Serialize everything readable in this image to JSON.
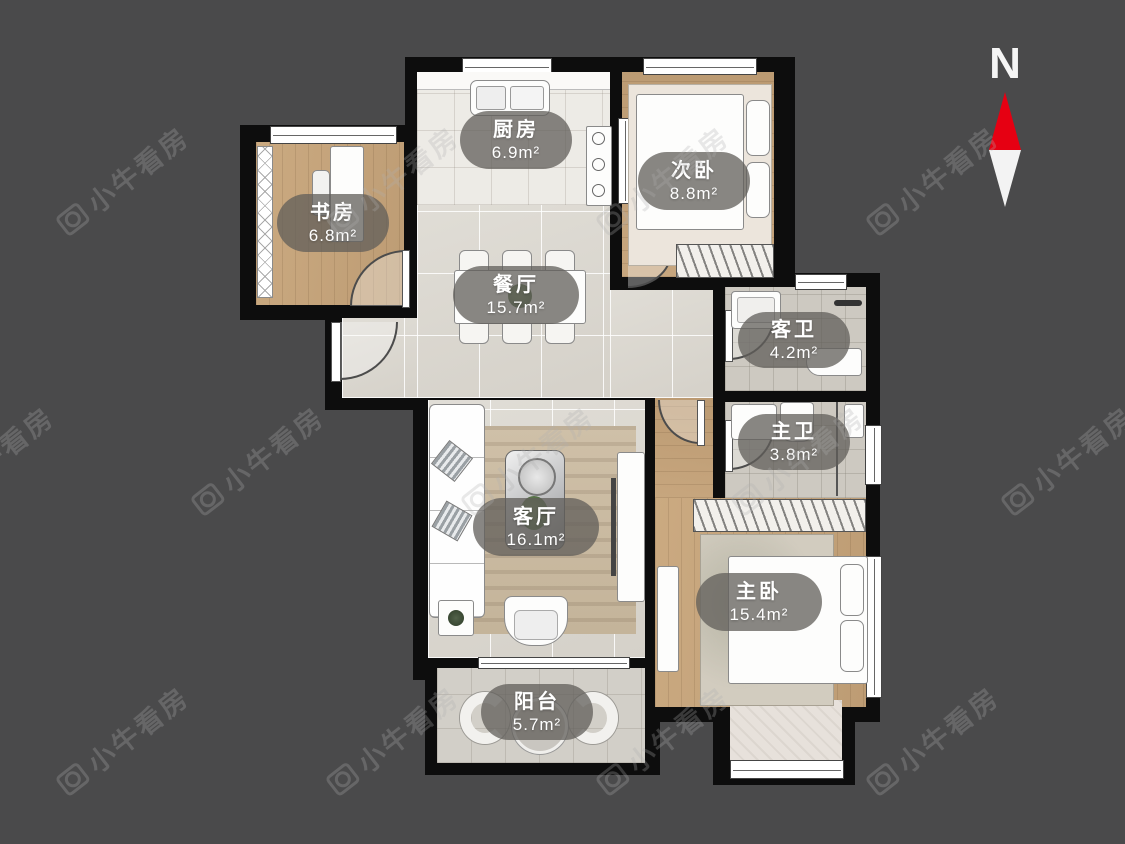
{
  "watermark": {
    "text": "小牛看房"
  },
  "compass": {
    "label": "N"
  },
  "colors": {
    "background": "#4a4a4b",
    "wall": "#0d0d0d",
    "compass_red": "#e60012",
    "compass_white": "#f5f5f5",
    "label_background": "rgba(96,93,89,0.75)",
    "label_text": "#ffffff",
    "watermark": "rgba(175,175,175,0.28)"
  },
  "rooms": [
    {
      "id": "kitchen",
      "name": "厨房",
      "area": "6.9m²"
    },
    {
      "id": "second-bedroom",
      "name": "次卧",
      "area": "8.8m²"
    },
    {
      "id": "study",
      "name": "书房",
      "area": "6.8m²"
    },
    {
      "id": "dining-room",
      "name": "餐厅",
      "area": "15.7m²"
    },
    {
      "id": "guest-bathroom",
      "name": "客卫",
      "area": "4.2m²"
    },
    {
      "id": "master-bathroom",
      "name": "主卫",
      "area": "3.8m²"
    },
    {
      "id": "living-room",
      "name": "客厅",
      "area": "16.1m²"
    },
    {
      "id": "master-bedroom",
      "name": "主卧",
      "area": "15.4m²"
    },
    {
      "id": "balcony",
      "name": "阳台",
      "area": "5.7m²"
    }
  ]
}
